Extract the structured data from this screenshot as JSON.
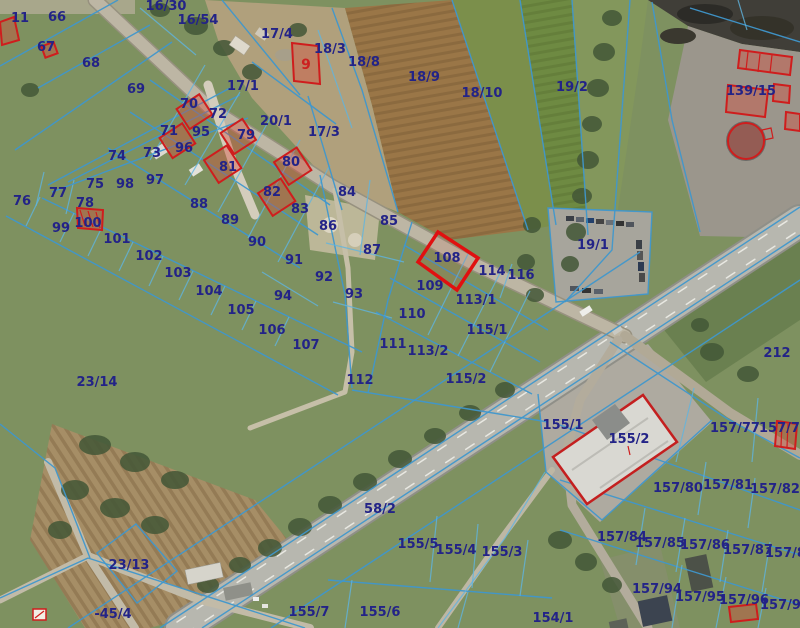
{
  "map": {
    "type": "cadastral-aerial-map",
    "colors": {
      "boundary": "#3f97cc",
      "label": "#232387",
      "highlight": "#cf1d1d"
    },
    "highlighted_parcels": [
      "9",
      "100",
      "108",
      "155/2",
      "139/15-buildings",
      "157/78-building",
      "157/96-building"
    ],
    "labels": [
      {
        "t": "11",
        "x": 20,
        "y": 17
      },
      {
        "t": "66",
        "x": 57,
        "y": 16
      },
      {
        "t": "67",
        "x": 46,
        "y": 46
      },
      {
        "t": "68",
        "x": 91,
        "y": 62
      },
      {
        "t": "69",
        "x": 136,
        "y": 88
      },
      {
        "t": "16/30",
        "x": 166,
        "y": 5
      },
      {
        "t": "16/54",
        "x": 198,
        "y": 19
      },
      {
        "t": "17/4",
        "x": 277,
        "y": 33
      },
      {
        "t": "9",
        "x": 306,
        "y": 64,
        "red": true
      },
      {
        "t": "18/3",
        "x": 330,
        "y": 48
      },
      {
        "t": "18/8",
        "x": 364,
        "y": 61
      },
      {
        "t": "18/9",
        "x": 424,
        "y": 76
      },
      {
        "t": "18/10",
        "x": 482,
        "y": 92
      },
      {
        "t": "19/2",
        "x": 572,
        "y": 86
      },
      {
        "t": "139/15",
        "x": 751,
        "y": 90
      },
      {
        "t": "17/1",
        "x": 243,
        "y": 85
      },
      {
        "t": "70",
        "x": 189,
        "y": 103
      },
      {
        "t": "72",
        "x": 218,
        "y": 113
      },
      {
        "t": "20/1",
        "x": 276,
        "y": 120
      },
      {
        "t": "17/3",
        "x": 324,
        "y": 131
      },
      {
        "t": "71",
        "x": 169,
        "y": 130
      },
      {
        "t": "95",
        "x": 201,
        "y": 131
      },
      {
        "t": "96",
        "x": 184,
        "y": 147
      },
      {
        "t": "79",
        "x": 246,
        "y": 134
      },
      {
        "t": "74",
        "x": 117,
        "y": 155
      },
      {
        "t": "73",
        "x": 152,
        "y": 152
      },
      {
        "t": "81",
        "x": 228,
        "y": 166
      },
      {
        "t": "80",
        "x": 291,
        "y": 161
      },
      {
        "t": "82",
        "x": 272,
        "y": 191
      },
      {
        "t": "83",
        "x": 300,
        "y": 208
      },
      {
        "t": "75",
        "x": 95,
        "y": 183
      },
      {
        "t": "98",
        "x": 125,
        "y": 183
      },
      {
        "t": "97",
        "x": 155,
        "y": 179
      },
      {
        "t": "76",
        "x": 22,
        "y": 200
      },
      {
        "t": "77",
        "x": 58,
        "y": 192
      },
      {
        "t": "78",
        "x": 85,
        "y": 202
      },
      {
        "t": "88",
        "x": 199,
        "y": 203
      },
      {
        "t": "89",
        "x": 230,
        "y": 219
      },
      {
        "t": "99",
        "x": 61,
        "y": 227
      },
      {
        "t": "100",
        "x": 88,
        "y": 222
      },
      {
        "t": "101",
        "x": 117,
        "y": 238
      },
      {
        "t": "102",
        "x": 149,
        "y": 255
      },
      {
        "t": "103",
        "x": 178,
        "y": 272
      },
      {
        "t": "104",
        "x": 209,
        "y": 290
      },
      {
        "t": "105",
        "x": 241,
        "y": 309
      },
      {
        "t": "106",
        "x": 272,
        "y": 329
      },
      {
        "t": "107",
        "x": 306,
        "y": 344
      },
      {
        "t": "84",
        "x": 347,
        "y": 191
      },
      {
        "t": "86",
        "x": 328,
        "y": 225
      },
      {
        "t": "85",
        "x": 389,
        "y": 220
      },
      {
        "t": "87",
        "x": 372,
        "y": 249
      },
      {
        "t": "90",
        "x": 257,
        "y": 241
      },
      {
        "t": "91",
        "x": 294,
        "y": 259
      },
      {
        "t": "92",
        "x": 324,
        "y": 276
      },
      {
        "t": "93",
        "x": 354,
        "y": 293
      },
      {
        "t": "94",
        "x": 283,
        "y": 295
      },
      {
        "t": "108",
        "x": 447,
        "y": 257
      },
      {
        "t": "109",
        "x": 430,
        "y": 285
      },
      {
        "t": "114",
        "x": 492,
        "y": 270
      },
      {
        "t": "116",
        "x": 521,
        "y": 274
      },
      {
        "t": "113/1",
        "x": 476,
        "y": 299
      },
      {
        "t": "110",
        "x": 412,
        "y": 313
      },
      {
        "t": "115/1",
        "x": 487,
        "y": 329
      },
      {
        "t": "111",
        "x": 393,
        "y": 343
      },
      {
        "t": "113/2",
        "x": 428,
        "y": 350
      },
      {
        "t": "112",
        "x": 360,
        "y": 379
      },
      {
        "t": "115/2",
        "x": 466,
        "y": 378
      },
      {
        "t": "19/1",
        "x": 593,
        "y": 244
      },
      {
        "t": "212",
        "x": 777,
        "y": 352
      },
      {
        "t": "23/14",
        "x": 97,
        "y": 381
      },
      {
        "t": "23/13",
        "x": 129,
        "y": 564
      },
      {
        "t": "-45/4",
        "x": 113,
        "y": 613
      },
      {
        "t": "155/1",
        "x": 563,
        "y": 424
      },
      {
        "t": "155/2",
        "x": 629,
        "y": 438
      },
      {
        "t": "157/77",
        "x": 735,
        "y": 427
      },
      {
        "t": "157/78",
        "x": 784,
        "y": 427
      },
      {
        "t": "157/80",
        "x": 678,
        "y": 487
      },
      {
        "t": "157/81",
        "x": 728,
        "y": 484
      },
      {
        "t": "157/82",
        "x": 775,
        "y": 488
      },
      {
        "t": "58/2",
        "x": 380,
        "y": 508
      },
      {
        "t": "155/5",
        "x": 418,
        "y": 543
      },
      {
        "t": "155/4",
        "x": 456,
        "y": 549
      },
      {
        "t": "155/3",
        "x": 502,
        "y": 551
      },
      {
        "t": "155/7",
        "x": 309,
        "y": 611
      },
      {
        "t": "155/6",
        "x": 380,
        "y": 611
      },
      {
        "t": "154/1",
        "x": 553,
        "y": 617
      },
      {
        "t": "157/84",
        "x": 622,
        "y": 536
      },
      {
        "t": "157/85",
        "x": 660,
        "y": 542
      },
      {
        "t": "157/86",
        "x": 705,
        "y": 544
      },
      {
        "t": "157/87",
        "x": 748,
        "y": 549
      },
      {
        "t": "157/88",
        "x": 790,
        "y": 552
      },
      {
        "t": "157/94",
        "x": 657,
        "y": 588
      },
      {
        "t": "157/95",
        "x": 700,
        "y": 596
      },
      {
        "t": "157/96",
        "x": 744,
        "y": 599
      },
      {
        "t": "157/97",
        "x": 785,
        "y": 604
      }
    ]
  }
}
